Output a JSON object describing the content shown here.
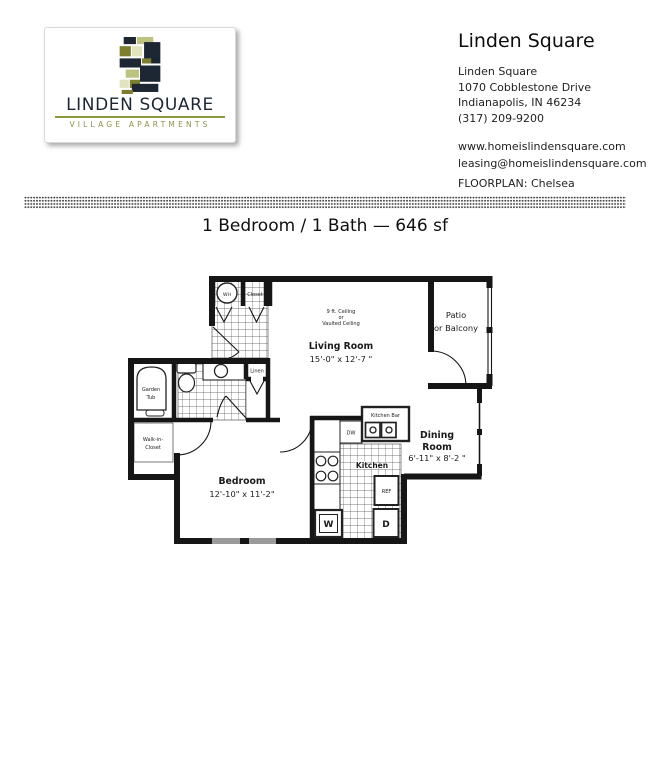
{
  "colors": {
    "navy": "#1c2733",
    "olive": "#7b7f2e",
    "sage": "#bdc37f",
    "pale": "#e1e4bf",
    "rule_green": "#8a9a3c",
    "ink": "#1a1a1a",
    "window_gray": "#9a9a9a"
  },
  "logo": {
    "name": "LINDEN SQUARE",
    "tagline": "VILLAGE APARTMENTS",
    "mark_icon": "mosaic-s-logo"
  },
  "contact": {
    "title": "Linden Square",
    "address_lines": [
      "Linden Square",
      "1070 Cobblestone Drive",
      "Indianapolis, IN 46234",
      "(317) 209-9200"
    ],
    "website": "www.homeislindensquare.com",
    "email": "leasing@homeislindensquare.com",
    "floorplan_label": "FLOORPLAN: Chelsea"
  },
  "plan": {
    "title": "1 Bedroom / 1 Bath — 646 sf",
    "labels": {
      "ceiling_1": "9 ft. Ceiling",
      "ceiling_2": "or",
      "ceiling_3": "Vaulted Ceiling",
      "living_room": "Living Room",
      "living_dims": "15'-0\" x 12'-7  \"",
      "patio_1": "Patio",
      "patio_2": "or Balcony",
      "dining_1": "Dining",
      "dining_2": "Room",
      "dining_dims": "6'-11\" x 8'-2  \"",
      "kitchen": "Kitchen",
      "kitchen_bar": "Kitchen Bar",
      "dw": "DW",
      "ref": "REF",
      "washer": "W",
      "dryer": "D",
      "bedroom": "Bedroom",
      "bedroom_dims": "12'-10\" x  11'-2\"",
      "garden_tub_1": "Garden",
      "garden_tub_2": "Tub",
      "walk_in_1": "Walk-in-",
      "walk_in_2": "Closet",
      "closet": "Closet",
      "wh": "WH",
      "linen": "Linen"
    }
  }
}
